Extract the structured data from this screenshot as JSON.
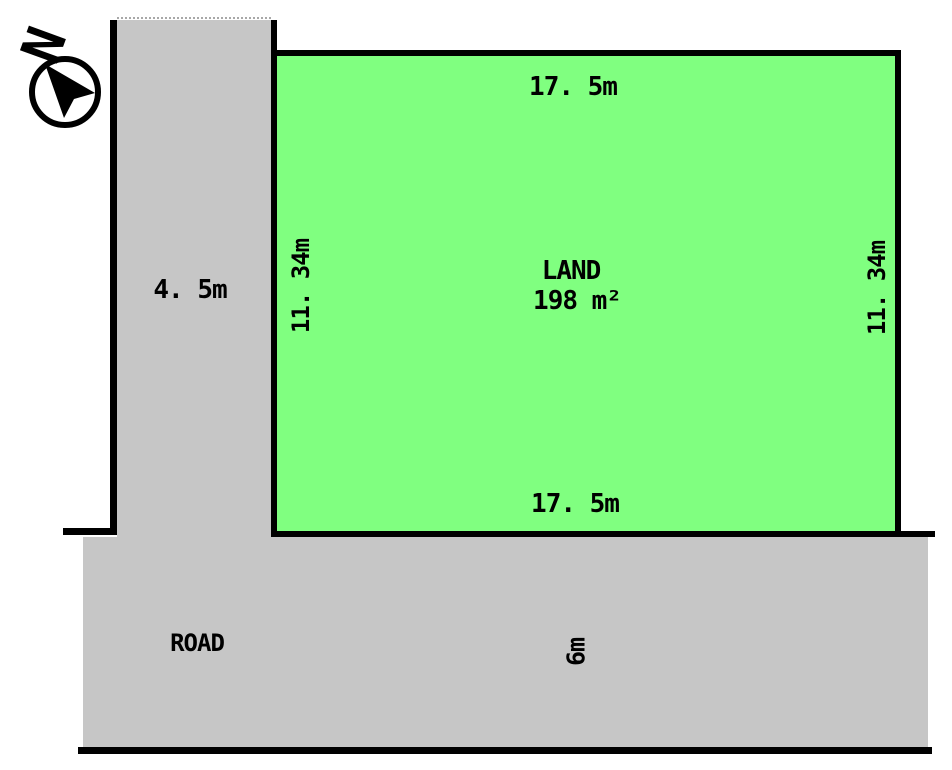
{
  "diagram": {
    "compass": {
      "label": "N"
    },
    "plot": {
      "name_label": "LAND",
      "area_label": "198 m²",
      "dim_top": "17. 5m",
      "dim_bottom": "17. 5m",
      "dim_left": "11. 34m",
      "dim_right": "11. 34m",
      "fill_color": "#80ff80"
    },
    "roads": {
      "name_label": "ROAD",
      "vertical_road_width": "4. 5m",
      "horizontal_road_width": "6m",
      "fill_color": "#c6c6c6"
    },
    "colors": {
      "outline": "#000000",
      "background": "#ffffff",
      "text": "#000000"
    }
  }
}
